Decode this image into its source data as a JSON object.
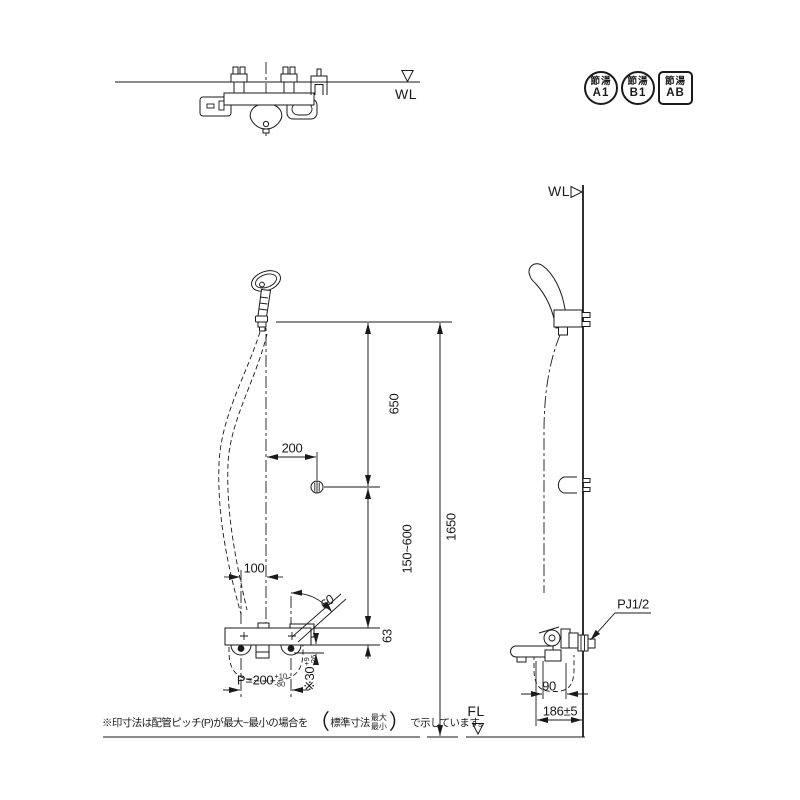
{
  "badges": {
    "items": [
      {
        "line1": "節湯",
        "line2": "A1",
        "shape": "circle"
      },
      {
        "line1": "節湯",
        "line2": "B1",
        "shape": "circle"
      },
      {
        "line1": "節湯",
        "line2": "AB",
        "shape": "square"
      }
    ]
  },
  "labels": {
    "wall_line_top": "WL",
    "wall_line_side": "WL",
    "floor_line": "FL",
    "connection_size": "PJ1/2"
  },
  "dimensions": {
    "head_to_hook": "650",
    "hook_offset": "200",
    "hook_range": "150~600",
    "overall_height": "1650",
    "body_to_leg": "63",
    "half_pitch": "100",
    "leg_swing_angle": "60",
    "pitch": "P=200",
    "pitch_max": "+10",
    "pitch_min": "-80",
    "leg_offset": "※30",
    "leg_offset_max": "+9",
    "leg_offset_min": "-26",
    "wall_to_center": "90",
    "wall_to_spout": "186±5"
  },
  "note": {
    "prefix": "※印寸法は配管ピッチ(P)が最大~最小の場合を",
    "paren_open": "（",
    "standard": "標準寸法",
    "max": "最大",
    "min": "最小",
    "paren_close": "）",
    "suffix": "で示しています。"
  }
}
